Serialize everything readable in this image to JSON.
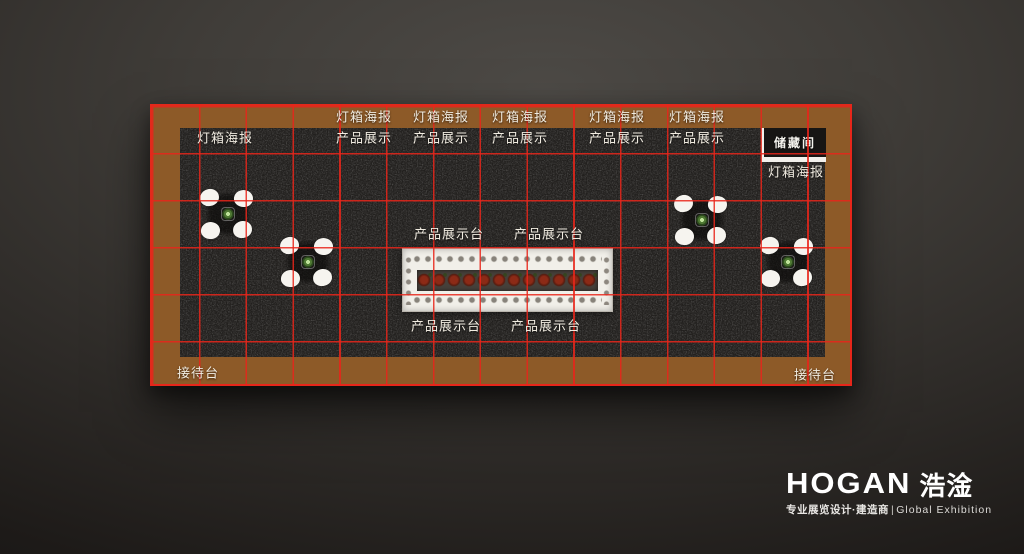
{
  "plan": {
    "labels": {
      "lightbox": "灯箱海报",
      "product_display": "产品展示",
      "display_table": "产品展示台",
      "storage": "储藏间",
      "reception": "接待台"
    },
    "grid": {
      "columns": 15,
      "rows": 6
    },
    "colors": {
      "border": "#8d5a28",
      "carpet": "#45423e",
      "grid_line": "#e9251a",
      "counter_top": "#f1efe9"
    },
    "furniture": {
      "round_table_groups": 4,
      "chairs_per_group": 4,
      "central_display_counters": 1
    }
  },
  "brand": {
    "logo": "HOGAN",
    "logo_cn": "浩淦",
    "tagline_cn": "专业展览设计·建造商",
    "tagline_divider": "|",
    "tagline_en": "Global Exhibition"
  }
}
